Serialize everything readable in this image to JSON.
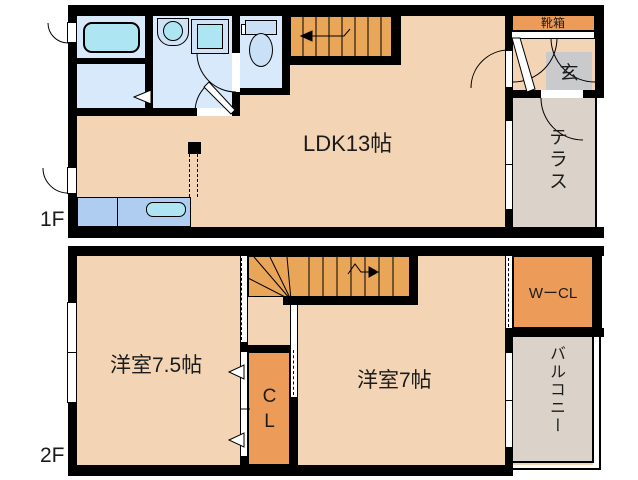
{
  "colors": {
    "wall": "#000000",
    "floor": "#F3D5B5",
    "wet": "#D7E9FA",
    "fixture": "#ADE6F2",
    "fixture_light": "#CFE2F6",
    "toilet_fill": "#C9E0F6",
    "stairs": "#E9A558",
    "storage": "#EC9C58",
    "entry": "#C9CACC",
    "outdoor": "#DBD3C9",
    "counter": "#AECDF0"
  },
  "floor1": {
    "label": "1F",
    "ldk_label": "LDK13帖",
    "shoebox_label": "靴箱",
    "entrance_label": "玄",
    "terrace_label": "テラス"
  },
  "floor2": {
    "label": "2F",
    "room75_label": "洋室7.5帖",
    "room7_label": "洋室7帖",
    "closet_label": "CL",
    "walkin_closet_label": "WーCL",
    "balcony_label": "バルコニー"
  }
}
